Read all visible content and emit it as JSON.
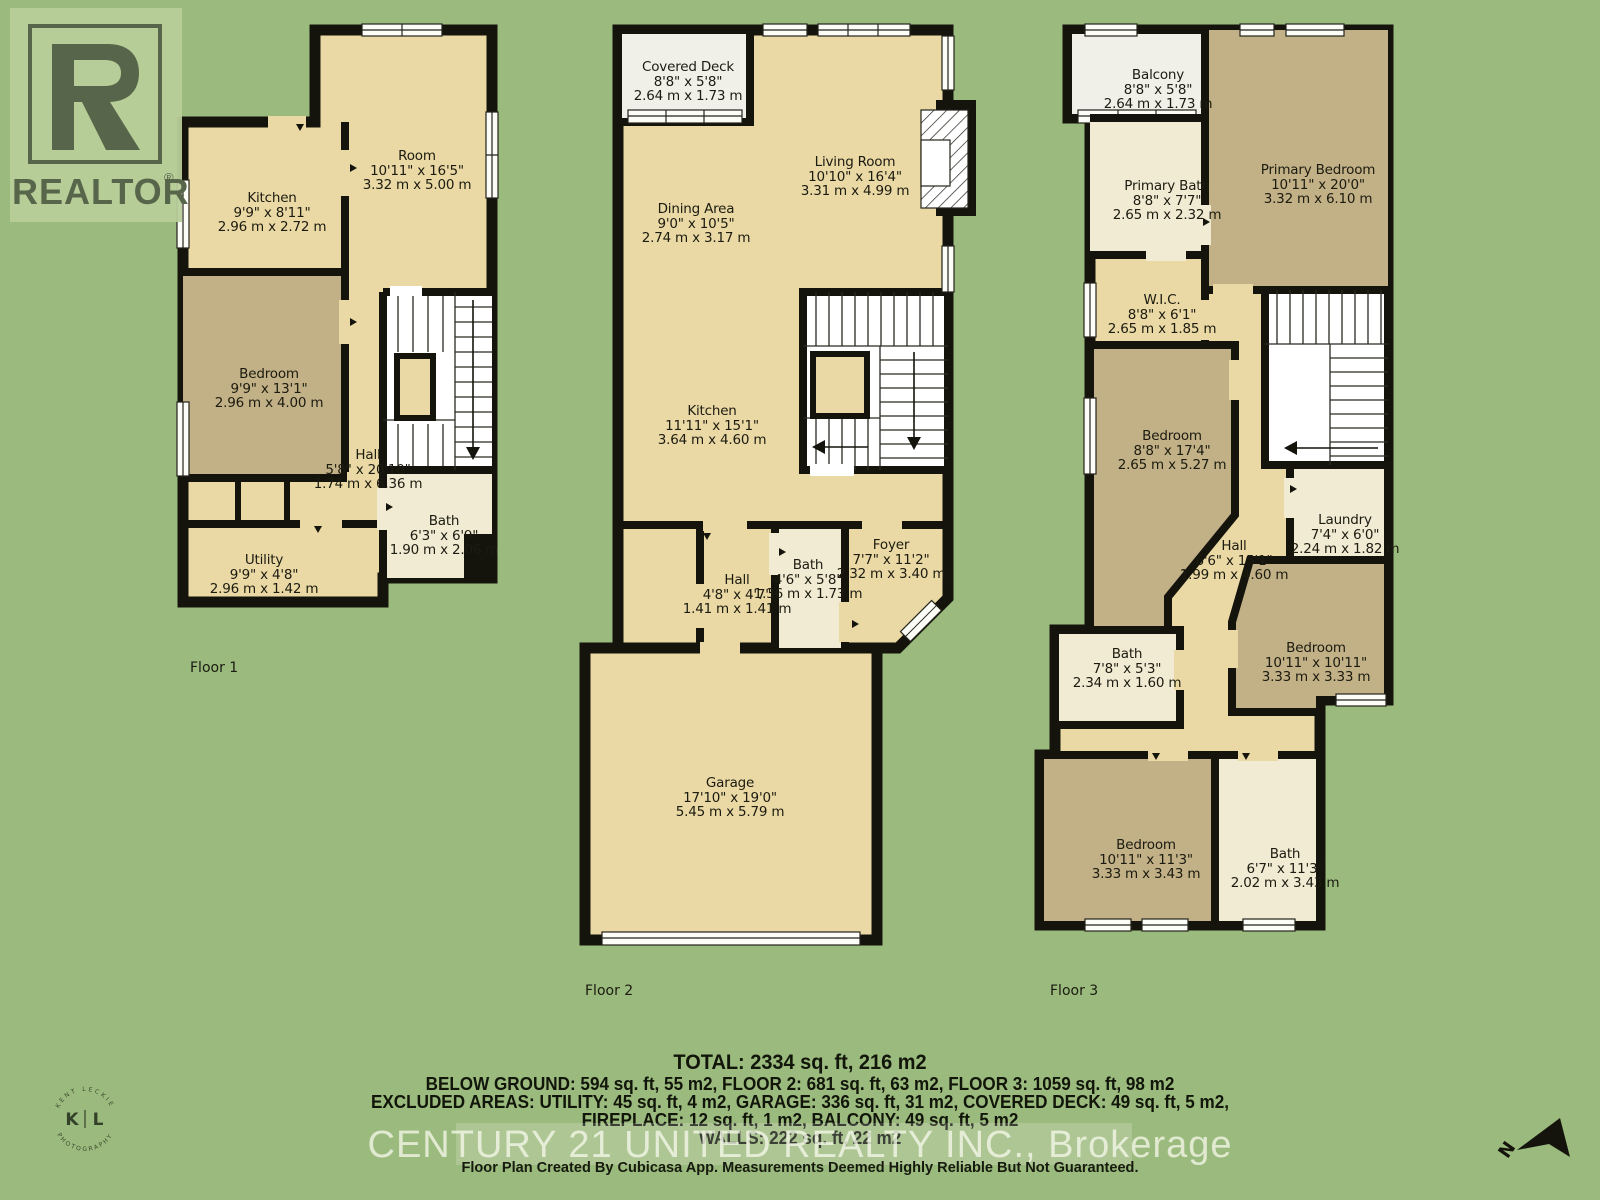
{
  "palette": {
    "background": "#9bba7d",
    "wall": "#14140c",
    "room_cream": "#ebd9a5",
    "room_tan": "#c2b086",
    "room_bath": "#f2ebd4",
    "room_deck": "#f0efe8",
    "logo_panel": "#b7cd99",
    "logo_ink": "#57654a",
    "text": "#1b1b10"
  },
  "branding": {
    "logo_word": "REALTOR",
    "logo_registered": "®",
    "watermark": "CENTURY 21 UNITED REALTY INC., Brokerage",
    "disclaimer": "Floor Plan Created By Cubicasa App. Measurements Deemed Highly Reliable But Not Guaranteed."
  },
  "photographer_badge": {
    "left_letter": "K",
    "right_letter": "L",
    "top_arc": "KENT LECKIE",
    "bottom_arc": "PHOTOGRAPHY"
  },
  "compass": {
    "label": "N"
  },
  "summary": {
    "total": "TOTAL: 2334 sq. ft, 216 m2",
    "line1": "BELOW GROUND: 594 sq. ft, 55 m2, FLOOR 2: 681 sq. ft, 63 m2, FLOOR 3: 1059 sq. ft, 98 m2",
    "line2": "EXCLUDED AREAS: UTILITY: 45 sq. ft, 4 m2, GARAGE: 336 sq. ft, 31 m2, COVERED DECK: 49 sq. ft, 5 m2,",
    "line3": "FIREPLACE: 12 sq. ft, 1 m2, BALCONY: 49 sq. ft, 5 m2",
    "line4": "WALLS: 222 sq. ft, 22 m2"
  },
  "floors": [
    {
      "label": "Floor 1",
      "rooms": [
        {
          "name": "Room",
          "imperial": "10'11\" x 16'5\"",
          "metric": "3.32 m x 5.00 m"
        },
        {
          "name": "Kitchen",
          "imperial": "9'9\" x 8'11\"",
          "metric": "2.96 m x 2.72 m"
        },
        {
          "name": "Bedroom",
          "imperial": "9'9\" x 13'1\"",
          "metric": "2.96 m x 4.00 m"
        },
        {
          "name": "Hall",
          "imperial": "5'8\" x 20'10\"",
          "metric": "1.74 m x 6.36 m"
        },
        {
          "name": "Bath",
          "imperial": "6'3\" x 6'9\"",
          "metric": "1.90 m x 2.06 m"
        },
        {
          "name": "Utility",
          "imperial": "9'9\" x 4'8\"",
          "metric": "2.96 m x 1.42 m"
        }
      ]
    },
    {
      "label": "Floor 2",
      "rooms": [
        {
          "name": "Covered Deck",
          "imperial": "8'8\" x 5'8\"",
          "metric": "2.64 m x 1.73 m"
        },
        {
          "name": "Living Room",
          "imperial": "10'10\" x 16'4\"",
          "metric": "3.31 m x 4.99 m"
        },
        {
          "name": "Dining Area",
          "imperial": "9'0\" x 10'5\"",
          "metric": "2.74 m x 3.17 m"
        },
        {
          "name": "Kitchen",
          "imperial": "11'11\" x 15'1\"",
          "metric": "3.64 m x 4.60 m"
        },
        {
          "name": "Foyer",
          "imperial": "7'7\" x 11'2\"",
          "metric": "2.32 m x 3.40 m"
        },
        {
          "name": "Bath",
          "imperial": "4'6\" x 5'8\"",
          "metric": "1.36 m x 1.73 m"
        },
        {
          "name": "Hall",
          "imperial": "4'8\" x 4'7\"",
          "metric": "1.41 m x 1.41 m"
        },
        {
          "name": "Garage",
          "imperial": "17'10\" x 19'0\"",
          "metric": "5.45 m x 5.79 m"
        }
      ]
    },
    {
      "label": "Floor 3",
      "rooms": [
        {
          "name": "Balcony",
          "imperial": "8'8\" x 5'8\"",
          "metric": "2.64 m x 1.73 m"
        },
        {
          "name": "Primary Bath",
          "imperial": "8'8\" x 7'7\"",
          "metric": "2.65 m x 2.32 m"
        },
        {
          "name": "Primary Bedroom",
          "imperial": "10'11\" x 20'0\"",
          "metric": "3.32 m x 6.10 m"
        },
        {
          "name": "W.I.C.",
          "imperial": "8'8\" x 6'1\"",
          "metric": "2.65 m x 1.85 m"
        },
        {
          "name": "Bedroom",
          "imperial": "8'8\" x 17'4\"",
          "metric": "2.65 m x 5.27 m"
        },
        {
          "name": "Hall",
          "imperial": "6'6\" x 15'1\"",
          "metric": "1.99 m x 4.60 m"
        },
        {
          "name": "Laundry",
          "imperial": "7'4\" x 6'0\"",
          "metric": "2.24 m x 1.82 m"
        },
        {
          "name": "Bedroom",
          "imperial": "10'11\" x 10'11\"",
          "metric": "3.33 m x 3.33 m"
        },
        {
          "name": "Bath",
          "imperial": "7'8\" x 5'3\"",
          "metric": "2.34 m x 1.60 m"
        },
        {
          "name": "Bedroom",
          "imperial": "10'11\" x 11'3\"",
          "metric": "3.33 m x 3.43 m"
        },
        {
          "name": "Bath",
          "imperial": "6'7\" x 11'3\"",
          "metric": "2.02 m x 3.43 m"
        }
      ]
    }
  ]
}
